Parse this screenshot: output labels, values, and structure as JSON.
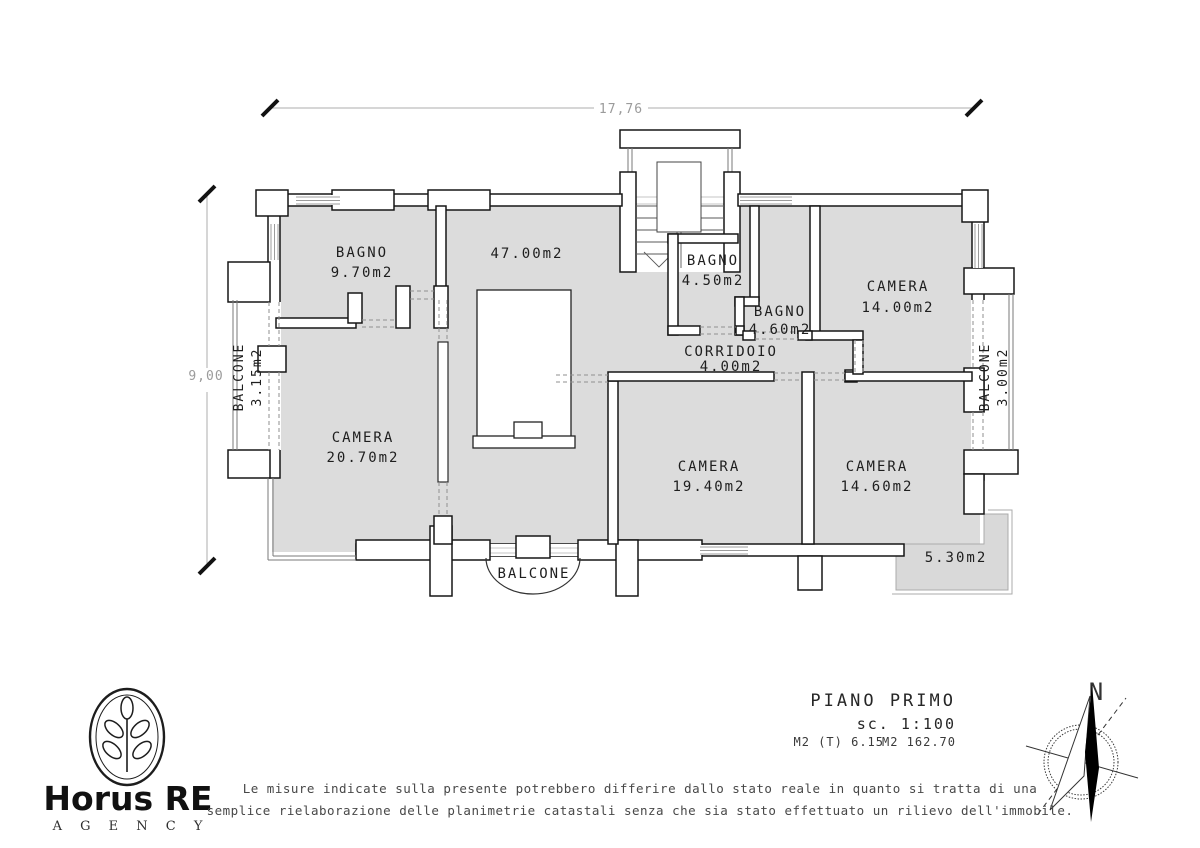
{
  "drawing": {
    "title": "PIANO PRIMO",
    "scale": "sc. 1:100",
    "area_note_left": "M2 (T) 6.15",
    "area_note_right": "M2 162.70"
  },
  "dimensions": {
    "width": "17,76",
    "height": "9,00"
  },
  "rooms": {
    "bagno_nw": {
      "name": "BAGNO",
      "area": "9.70m2"
    },
    "soggiorno": {
      "area": "47.00m2"
    },
    "bagno_c": {
      "name": "BAGNO",
      "area": "4.50m2"
    },
    "bagno_c2": {
      "name": "BAGNO",
      "area": "4.60m2"
    },
    "camera_ne": {
      "name": "CAMERA",
      "area": "14.00m2"
    },
    "corridoio": {
      "name": "CORRIDOIO",
      "area": "4.00m2"
    },
    "camera_w": {
      "name": "CAMERA",
      "area": "20.70m2"
    },
    "camera_s": {
      "name": "CAMERA",
      "area": "19.40m2"
    },
    "camera_se": {
      "name": "CAMERA",
      "area": "14.60m2"
    }
  },
  "balconies": {
    "left": {
      "name": "BALCONE",
      "area": "3.15m2"
    },
    "right": {
      "name": "BALCONE",
      "area": "3.00m2"
    },
    "bottom": {
      "name": "BALCONE"
    },
    "terrace": {
      "area": "5.30m2"
    }
  },
  "compass": {
    "north": "N"
  },
  "logo": {
    "brand": "Horus RE",
    "subtitle": "A G E N C Y"
  },
  "disclaimer": {
    "line1": "Le misure indicate sulla presente potrebbero differire dallo stato reale in quanto si tratta di una",
    "line2": "semplice rielaborazione delle planimetrie catastali senza che sia stato effettuato un rilievo dell'immobile."
  },
  "colors": {
    "room_fill": "#dcdcdc",
    "wall_line": "#161616",
    "dim_gray": "#9b9b9b"
  }
}
